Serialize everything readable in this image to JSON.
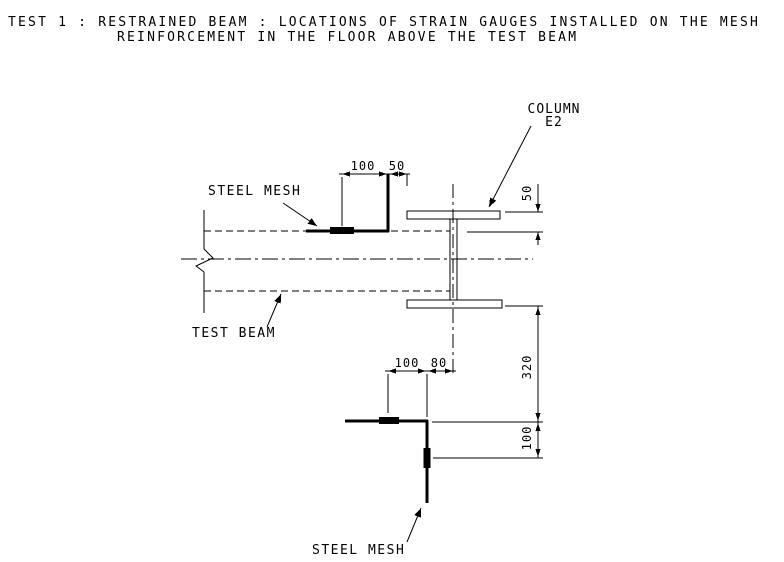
{
  "title": {
    "line1": "TEST 1 : RESTRAINED BEAM : LOCATIONS OF STRAIN GAUGES INSTALLED ON THE MESH",
    "line2": "REINFORCEMENT IN THE FLOOR ABOVE THE TEST BEAM"
  },
  "labels": {
    "steel_mesh_top": "STEEL MESH",
    "test_beam": "TEST BEAM",
    "steel_mesh_bottom": "STEEL MESH",
    "column_line1": "COLUMN",
    "column_line2": "E2"
  },
  "dimensions": {
    "top_gauge_offset": "100",
    "top_mesh_to_flange": "50",
    "flange_to_slab_edge": "50",
    "flange_to_bottom_mesh": "320",
    "bottom_mesh_to_gauge": "100",
    "bottom_gauge_offset": "100",
    "bottom_mesh_to_column_cl": "80"
  },
  "colors": {
    "ink": "#000000",
    "background": "#ffffff"
  }
}
